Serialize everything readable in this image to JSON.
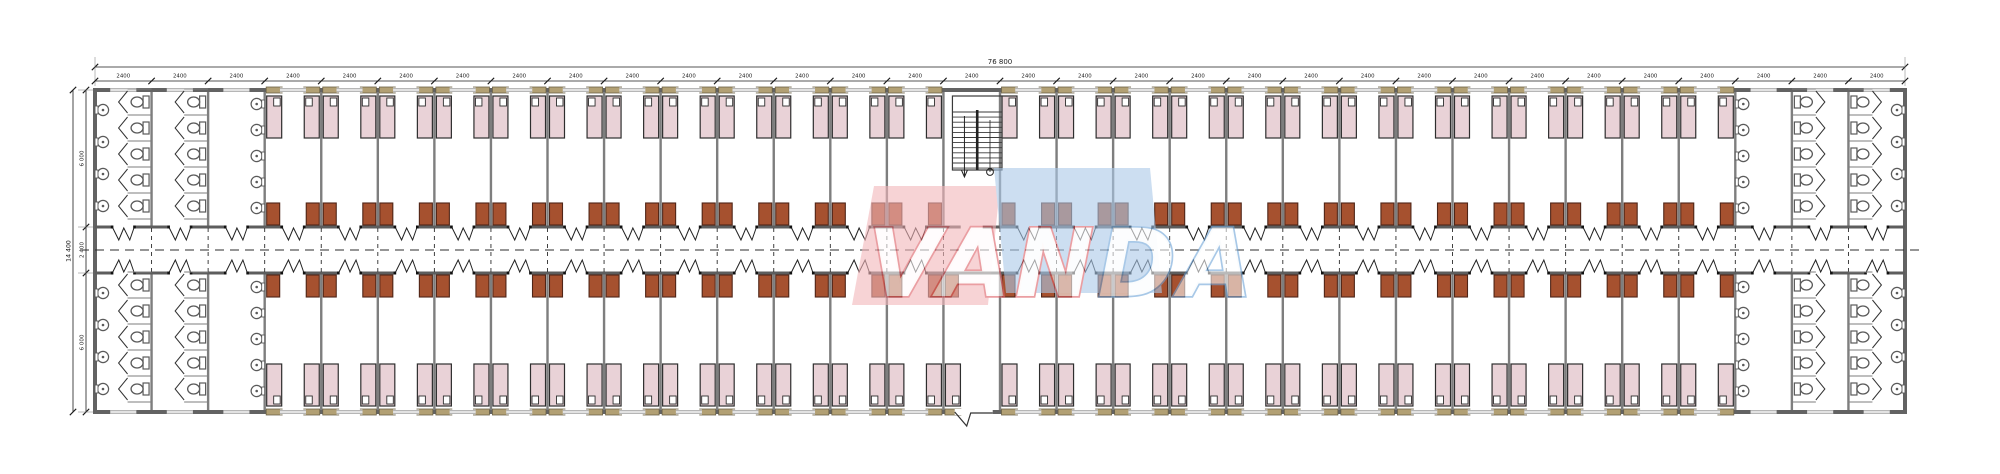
{
  "drawing": {
    "type": "architectural-floor-plan",
    "watermark": {
      "full_text": "VANDA",
      "text_left": "VAN",
      "text_right": "DA",
      "pink_fill": "#f2b6ba",
      "blue_fill": "#abc9e9",
      "outline_left": "#dd5f66",
      "outline_right": "#6fa5d8",
      "letter_fill": "#ffffff"
    },
    "dimensions": {
      "total_width_label": "76 800",
      "module_width_label": "2400",
      "total_height_label": "14 400",
      "room_depth_top_label": "6 000",
      "corridor_label": "2 400",
      "room_depth_bottom_label": "6 000"
    },
    "plan": {
      "module_count": 32,
      "sanitary_modules_left": [
        0,
        1,
        2
      ],
      "sanitary_modules_right": [
        29,
        30,
        31
      ],
      "stair_module_index": 15,
      "entrance_module_index": 15,
      "beds_per_room": 2,
      "cabinets_per_room": 2,
      "toilets_per_column": 5,
      "basins_per_inner_wall": 5,
      "basins_per_outer_wall": 4
    },
    "colors": {
      "background": "#ffffff",
      "outer_wall": "#636363",
      "partition": "#7e7e7e",
      "corridor_wall": "#5d5d5d",
      "bed_fill": "#e9d2d7",
      "bed_stroke": "#2e2e2e",
      "pillow_fill": "#ffffff",
      "cabinet_fill": "#a6512f",
      "cabinet_stroke": "#4f2517",
      "window_tan": "#b2a074",
      "fixture_stroke": "#5a5a5a",
      "dim_line": "#1b1b1b",
      "centerline": "#2c2c2c",
      "stair_stroke": "#3a3a3a"
    }
  }
}
